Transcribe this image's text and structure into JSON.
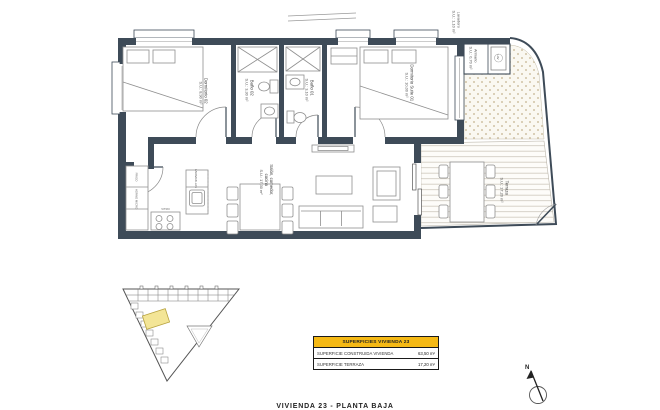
{
  "plan": {
    "caption": "VIVIENDA 23 - PLANTA BAJA",
    "compass": "N",
    "rooms": [
      {
        "name": "Dormitorio 02",
        "area": "S.U.: 8,90 m²"
      },
      {
        "name": "Baño 02",
        "area": "S.U.: 3,30 m²"
      },
      {
        "name": "Baño 01",
        "area": "S.U.: 3,10 m²"
      },
      {
        "name": "Dormitorio Suite 01",
        "area": "S.U.: 10,00 m²"
      },
      {
        "name": "Salón, comedor,",
        "name2": "cocina",
        "area": "S.U.: 17,30 m²"
      },
      {
        "name": "Terraza",
        "area": "S.U.: 17,20 m²"
      },
      {
        "name": "Lavadero",
        "area": "S.U.: 1,10 m²"
      },
      {
        "name": "Armario",
        "area": "S.U.: 0,70 m²"
      }
    ],
    "kitchen": {
      "fridge": "FRIGO",
      "oven": "HORNO MICRO",
      "hob": "VITRO",
      "dishwasher": "LAVAVAJILLAS",
      "washer": "LAV"
    }
  },
  "summary_table": {
    "header": "SUPERFICIES VIVIENDA 23",
    "rows": [
      {
        "label": "SUPERFICIE CONSTRUIDA VIVIENDA",
        "value": "63,50 m²"
      },
      {
        "label": "SUPERFICIE TERRAZA",
        "value": "17,20 m²"
      }
    ]
  },
  "colors": {
    "wall": "#3e4b58",
    "accent_yellow": "#f5b915",
    "highlight_unit": "#f3e596"
  }
}
